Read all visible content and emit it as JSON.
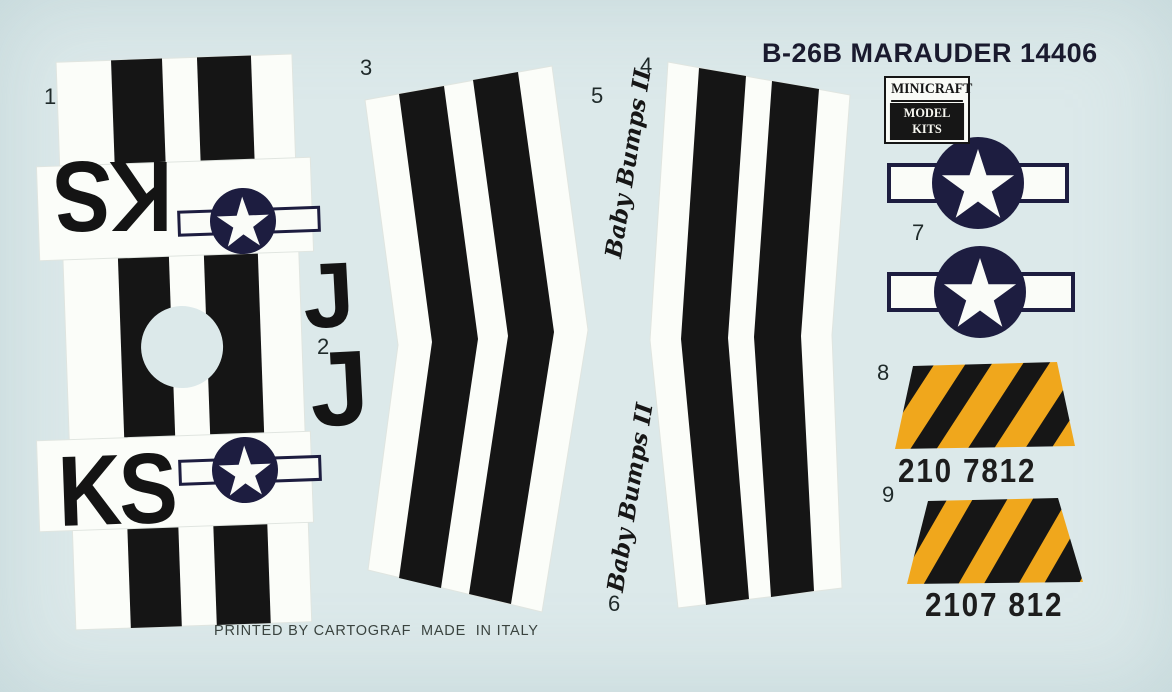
{
  "sheet": {
    "title": "B-26B MARAUDER 14406",
    "brand": {
      "line1": "MINICRAFT",
      "line2": "MODEL KITS"
    },
    "footer": "PRINTED BY CARTOGRAF  MADE  IN ITALY"
  },
  "colors": {
    "background": "#dce9ea",
    "panel_white": "#fbfdf9",
    "stripe_black": "#151515",
    "navy": "#1d1d40",
    "star_white": "#fafcf8",
    "yellow": "#f0a71c",
    "hazard_black": "#161616"
  },
  "labels": [
    "1",
    "2",
    "3",
    "4",
    "5",
    "6",
    "7",
    "8",
    "9"
  ],
  "markings": {
    "tail_code_inverted": "KS",
    "tail_code": "KS",
    "squadron_letter_top": "J",
    "squadron_letter_bottom": "J",
    "nose_art_top": "Baby Bumps II",
    "nose_art_bottom": "Baby Bumps II",
    "serial_top": "210 7812",
    "serial_bottom": "2107 812"
  }
}
